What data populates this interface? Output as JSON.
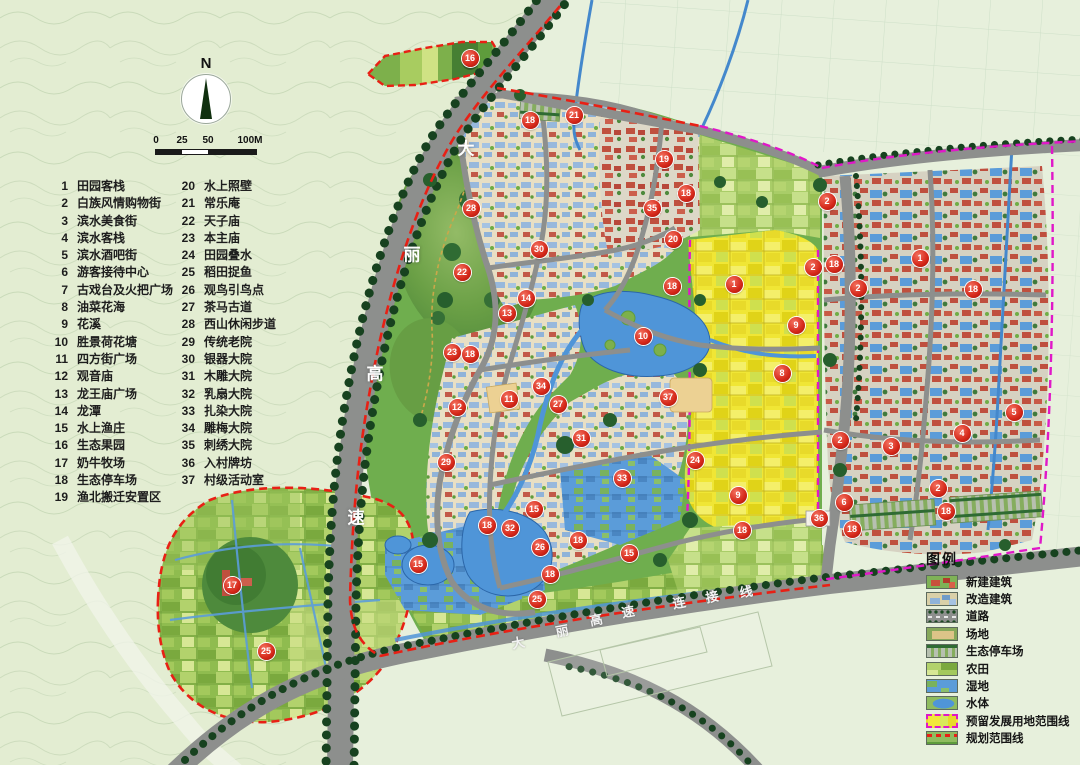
{
  "compass": {
    "label": "N"
  },
  "scalebar": {
    "labels": [
      "0",
      "25",
      "50",
      "100M"
    ]
  },
  "poi_list": {
    "col1": [
      {
        "n": "1",
        "t": "田园客栈"
      },
      {
        "n": "2",
        "t": "白族风情购物街"
      },
      {
        "n": "3",
        "t": "滨水美食街"
      },
      {
        "n": "4",
        "t": "滨水客栈"
      },
      {
        "n": "5",
        "t": "滨水酒吧街"
      },
      {
        "n": "6",
        "t": "游客接待中心"
      },
      {
        "n": "7",
        "t": "古戏台及火把广场"
      },
      {
        "n": "8",
        "t": "油菜花海"
      },
      {
        "n": "9",
        "t": "花溪"
      },
      {
        "n": "10",
        "t": "胜景荷花塘"
      },
      {
        "n": "11",
        "t": "四方街广场"
      },
      {
        "n": "12",
        "t": "观音庙"
      },
      {
        "n": "13",
        "t": "龙王庙广场"
      },
      {
        "n": "14",
        "t": "龙潭"
      },
      {
        "n": "15",
        "t": "水上渔庄"
      },
      {
        "n": "16",
        "t": "生态果园"
      },
      {
        "n": "17",
        "t": "奶牛牧场"
      },
      {
        "n": "18",
        "t": "生态停车场"
      },
      {
        "n": "19",
        "t": "渔北搬迁安置区"
      }
    ],
    "col2": [
      {
        "n": "20",
        "t": "水上照壁"
      },
      {
        "n": "21",
        "t": "常乐庵"
      },
      {
        "n": "22",
        "t": "天子庙"
      },
      {
        "n": "23",
        "t": "本主庙"
      },
      {
        "n": "24",
        "t": "田园叠水"
      },
      {
        "n": "25",
        "t": "稻田捉鱼"
      },
      {
        "n": "26",
        "t": "观鸟引鸟点"
      },
      {
        "n": "27",
        "t": "茶马古道"
      },
      {
        "n": "28",
        "t": "西山休闲步道"
      },
      {
        "n": "29",
        "t": "传统老院"
      },
      {
        "n": "30",
        "t": "银器大院"
      },
      {
        "n": "31",
        "t": "木雕大院"
      },
      {
        "n": "32",
        "t": "乳扇大院"
      },
      {
        "n": "33",
        "t": "扎染大院"
      },
      {
        "n": "34",
        "t": "雕梅大院"
      },
      {
        "n": "35",
        "t": "刺绣大院"
      },
      {
        "n": "36",
        "t": "入村牌坊"
      },
      {
        "n": "37",
        "t": "村级活动室"
      }
    ]
  },
  "road_labels": {
    "highway": [
      {
        "ch": "大",
        "x": 466,
        "y": 147
      },
      {
        "ch": "丽",
        "x": 412,
        "y": 253
      },
      {
        "ch": "高",
        "x": 375,
        "y": 372
      },
      {
        "ch": "速",
        "x": 356,
        "y": 516
      }
    ],
    "connector": [
      {
        "ch": "大",
        "x": 518,
        "y": 642
      },
      {
        "ch": "丽",
        "x": 562,
        "y": 630
      },
      {
        "ch": "高",
        "x": 596,
        "y": 619
      },
      {
        "ch": "速",
        "x": 628,
        "y": 611
      },
      {
        "ch": "连",
        "x": 679,
        "y": 602
      },
      {
        "ch": "接",
        "x": 712,
        "y": 596
      },
      {
        "ch": "线",
        "x": 746,
        "y": 591
      }
    ]
  },
  "legend": {
    "title": "图例",
    "items": [
      {
        "label": "新建建筑",
        "swatch": "new-building"
      },
      {
        "label": "改造建筑",
        "swatch": "renovated-building"
      },
      {
        "label": "道路",
        "swatch": "road"
      },
      {
        "label": "场地",
        "swatch": "site"
      },
      {
        "label": "生态停车场",
        "swatch": "eco-parking"
      },
      {
        "label": "农田",
        "swatch": "farmland"
      },
      {
        "label": "湿地",
        "swatch": "wetland"
      },
      {
        "label": "水体",
        "swatch": "water"
      },
      {
        "label": "预留发展用地范围线",
        "swatch": "reserved-line"
      },
      {
        "label": "规划范围线",
        "swatch": "planning-line"
      }
    ]
  },
  "markers": [
    {
      "n": "16",
      "x": 470,
      "y": 58
    },
    {
      "n": "18",
      "x": 530,
      "y": 120
    },
    {
      "n": "21",
      "x": 574,
      "y": 115
    },
    {
      "n": "19",
      "x": 664,
      "y": 159
    },
    {
      "n": "18",
      "x": 686,
      "y": 193
    },
    {
      "n": "2",
      "x": 827,
      "y": 201
    },
    {
      "n": "28",
      "x": 471,
      "y": 208
    },
    {
      "n": "35",
      "x": 652,
      "y": 208
    },
    {
      "n": "20",
      "x": 673,
      "y": 239
    },
    {
      "n": "30",
      "x": 539,
      "y": 249
    },
    {
      "n": "1",
      "x": 920,
      "y": 258
    },
    {
      "n": "18",
      "x": 834,
      "y": 264
    },
    {
      "n": "2",
      "x": 813,
      "y": 267
    },
    {
      "n": "22",
      "x": 462,
      "y": 272
    },
    {
      "n": "1",
      "x": 734,
      "y": 284
    },
    {
      "n": "18",
      "x": 672,
      "y": 286
    },
    {
      "n": "2",
      "x": 858,
      "y": 288
    },
    {
      "n": "18",
      "x": 973,
      "y": 289
    },
    {
      "n": "14",
      "x": 526,
      "y": 298
    },
    {
      "n": "13",
      "x": 507,
      "y": 313
    },
    {
      "n": "9",
      "x": 796,
      "y": 325
    },
    {
      "n": "10",
      "x": 643,
      "y": 336
    },
    {
      "n": "23",
      "x": 452,
      "y": 352
    },
    {
      "n": "18",
      "x": 470,
      "y": 354
    },
    {
      "n": "8",
      "x": 782,
      "y": 373
    },
    {
      "n": "34",
      "x": 541,
      "y": 386
    },
    {
      "n": "37",
      "x": 668,
      "y": 397
    },
    {
      "n": "11",
      "x": 509,
      "y": 399
    },
    {
      "n": "27",
      "x": 558,
      "y": 404
    },
    {
      "n": "12",
      "x": 457,
      "y": 407
    },
    {
      "n": "5",
      "x": 1014,
      "y": 412
    },
    {
      "n": "4",
      "x": 962,
      "y": 433
    },
    {
      "n": "31",
      "x": 581,
      "y": 438
    },
    {
      "n": "2",
      "x": 840,
      "y": 440
    },
    {
      "n": "3",
      "x": 891,
      "y": 446
    },
    {
      "n": "24",
      "x": 695,
      "y": 460
    },
    {
      "n": "29",
      "x": 446,
      "y": 462
    },
    {
      "n": "33",
      "x": 622,
      "y": 478
    },
    {
      "n": "2",
      "x": 938,
      "y": 488
    },
    {
      "n": "9",
      "x": 738,
      "y": 495
    },
    {
      "n": "6",
      "x": 844,
      "y": 502
    },
    {
      "n": "15",
      "x": 534,
      "y": 509
    },
    {
      "n": "18",
      "x": 946,
      "y": 511
    },
    {
      "n": "36",
      "x": 819,
      "y": 518
    },
    {
      "n": "18",
      "x": 487,
      "y": 525
    },
    {
      "n": "32",
      "x": 510,
      "y": 528
    },
    {
      "n": "18",
      "x": 852,
      "y": 529
    },
    {
      "n": "18",
      "x": 742,
      "y": 530
    },
    {
      "n": "18",
      "x": 578,
      "y": 540
    },
    {
      "n": "26",
      "x": 540,
      "y": 547
    },
    {
      "n": "15",
      "x": 629,
      "y": 553
    },
    {
      "n": "15",
      "x": 418,
      "y": 564
    },
    {
      "n": "18",
      "x": 550,
      "y": 574
    },
    {
      "n": "17",
      "x": 232,
      "y": 585
    },
    {
      "n": "25",
      "x": 537,
      "y": 599
    },
    {
      "n": "25",
      "x": 266,
      "y": 651
    }
  ],
  "colors": {
    "planning_line": "#e82015",
    "reserved_line": "#e018c8",
    "road": "#8d8f8d",
    "water": "#4f95d8",
    "marker": "#d5281a"
  }
}
